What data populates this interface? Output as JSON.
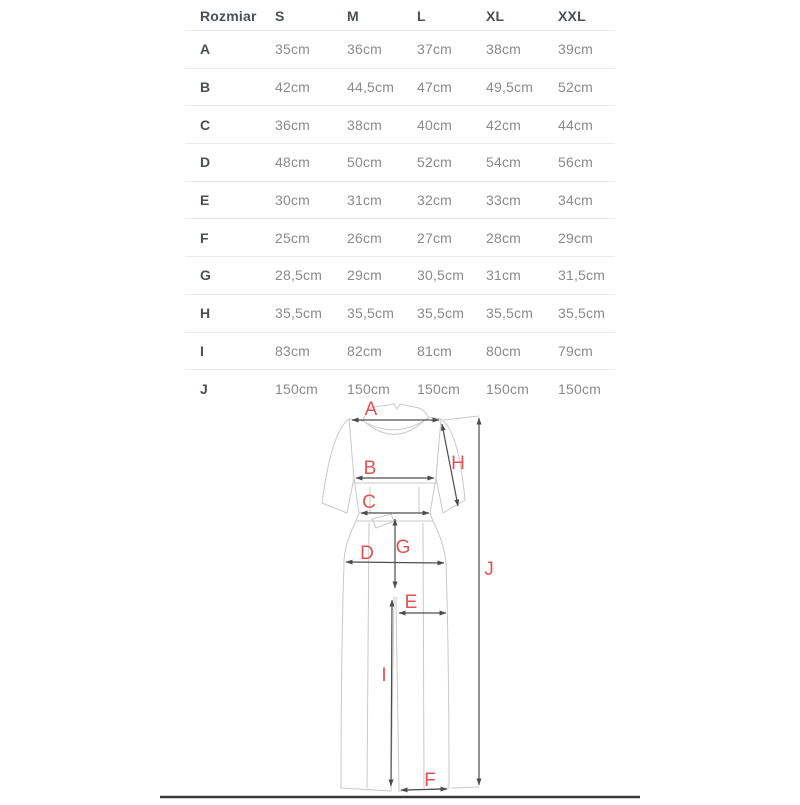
{
  "table": {
    "header": {
      "size_label": "Rozmiar",
      "cols": [
        "S",
        "M",
        "L",
        "XL",
        "XXL"
      ]
    },
    "rows": [
      {
        "label": "A",
        "values": [
          "35cm",
          "36cm",
          "37cm",
          "38cm",
          "39cm"
        ]
      },
      {
        "label": "B",
        "values": [
          "42cm",
          "44,5cm",
          "47cm",
          "49,5cm",
          "52cm"
        ]
      },
      {
        "label": "C",
        "values": [
          "36cm",
          "38cm",
          "40cm",
          "42cm",
          "44cm"
        ]
      },
      {
        "label": "D",
        "values": [
          "48cm",
          "50cm",
          "52cm",
          "54cm",
          "56cm"
        ]
      },
      {
        "label": "E",
        "values": [
          "30cm",
          "31cm",
          "32cm",
          "33cm",
          "34cm"
        ]
      },
      {
        "label": "F",
        "values": [
          "25cm",
          "26cm",
          "27cm",
          "28cm",
          "29cm"
        ]
      },
      {
        "label": "G",
        "values": [
          "28,5cm",
          "29cm",
          "30,5cm",
          "31cm",
          "31,5cm"
        ]
      },
      {
        "label": "H",
        "values": [
          "35,5cm",
          "35,5cm",
          "35,5cm",
          "35,5cm",
          "35,5cm"
        ]
      },
      {
        "label": "I",
        "values": [
          "83cm",
          "82cm",
          "81cm",
          "80cm",
          "79cm"
        ]
      },
      {
        "label": "J",
        "values": [
          "150cm",
          "150cm",
          "150cm",
          "150cm",
          "150cm"
        ]
      }
    ]
  },
  "diagram": {
    "labels": {
      "A": "A",
      "B": "B",
      "C": "C",
      "D": "D",
      "E": "E",
      "F": "F",
      "G": "G",
      "H": "H",
      "I": "I",
      "J": "J"
    },
    "label_color": "#e25252",
    "measure_line_color": "#4d4d4d",
    "outline_color": "#c9c9c9",
    "bottom_rule_color": "#3b3b3b"
  }
}
